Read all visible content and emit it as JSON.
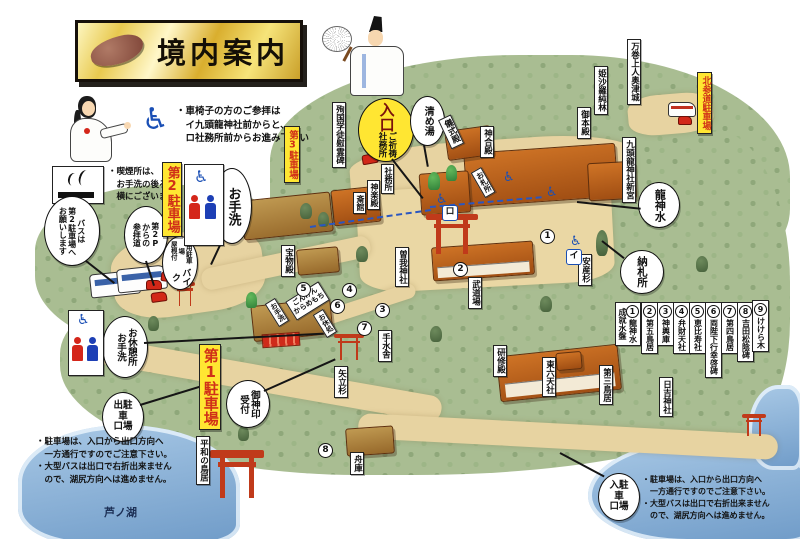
{
  "title": {
    "text": "境内案内"
  },
  "notes": {
    "accessibility": [
      "・車椅子の方のご参拝は",
      "　イ九頭龍神社前からと、",
      "　ロ社務所前からお進み下さい"
    ],
    "smoking": [
      "・喫煙所は、",
      "　お手洗の後ろと、",
      "　横にございます。"
    ],
    "parking_left": [
      "・駐車場は、入口から出口方向へ",
      "　一方通行ですのでご注意下さい。",
      "・大型バスは出口で右折出来ません",
      "　ので、湖尻方向へは進めません。"
    ],
    "parking_right": [
      "・駐車場は、入口から出口方向へ",
      "　一方通行ですのでご注意下さい。",
      "・大型バスは出口で右折出来ません",
      "　ので、湖尻方向へは進めません。"
    ]
  },
  "parking_signs": {
    "no1": "第1駐車場",
    "no2": "第2駐車場",
    "no3": "第3駐車場",
    "north": "北参道駐車場"
  },
  "bubbles": {
    "toilet": "お手洗",
    "bus_request": "バスは\n第2駐車場へ\nお願いします",
    "p2_approach": "第2P\nからの\n参拝道",
    "bike_main": "バイク",
    "bike_sub": "専用駐車場\n屋根付",
    "entrance_main": "入口",
    "entrance_sub": "ご祈祷\n社務所",
    "kiyomeyu": "清め湯",
    "ryujinsui": "龍神水",
    "nosatsusho": "納札所",
    "rest_area": "お休憩所\nお手洗",
    "parking_exit": "出駐\n車\n口場",
    "goshinin": "御神印\n受付",
    "parking_entrance": "入駐\n車\n口場"
  },
  "places": {
    "junkoku": "殉国学徒慰霊碑",
    "gishikiden": "儀式殿",
    "shingoden": "神合殿",
    "gohonden": "御本殿",
    "himeshara": "姫沙羅純林",
    "mangan": "万巻上人奥津城",
    "kuzuryu": "九頭龍神社新宮",
    "anzansugi": "安産杉",
    "shamusho": "社務所",
    "kaguraden": "神楽殿",
    "saikan": "斎館",
    "ofudasho": "お札所",
    "homotsuden": "宝物殿",
    "soga": "曽我神社",
    "budojo": "武道場",
    "temizusha": "手水舎",
    "kenshuden": "研修殿",
    "dairokuten": "東六天社",
    "yatatesugi": "矢立杉",
    "torii3": "第三鳥居",
    "hiyoshi": "日吉神社",
    "heiwa_torii": "平和の鳥居",
    "funagura": "舟庫",
    "otearai": "お手洗",
    "karamemochi": "ごんげん\nからめもち",
    "oyasumi": "お休処",
    "ashinoko": "芦ノ湖"
  },
  "legend": [
    {
      "n": "1",
      "t": "龍神水\n成就水盤"
    },
    {
      "n": "2",
      "t": "第五鳥居"
    },
    {
      "n": "3",
      "t": "神輿庫"
    },
    {
      "n": "4",
      "t": "弁財天社"
    },
    {
      "n": "5",
      "t": "恵比寿社"
    },
    {
      "n": "6",
      "t": "両陛下行幸啓碑"
    },
    {
      "n": "7",
      "t": "第四鳥居"
    },
    {
      "n": "8",
      "t": "吉田松陰碑"
    },
    {
      "n": "9",
      "t": "けけら木"
    }
  ],
  "map_numbers": [
    "1",
    "2",
    "3",
    "4",
    "5",
    "6",
    "7",
    "8"
  ],
  "route_markers": {
    "i": "イ",
    "ro": "ロ"
  },
  "icons": {
    "wheelchair": "♿"
  },
  "colors": {
    "sign_yellow": "#ffe632",
    "sign_red": "#d03018",
    "forest": "#a9bd92",
    "path": "#e7d3a1",
    "lake": "#6f9bc8",
    "roof": "#b75c1d",
    "route_blue": "#2a56c0"
  }
}
